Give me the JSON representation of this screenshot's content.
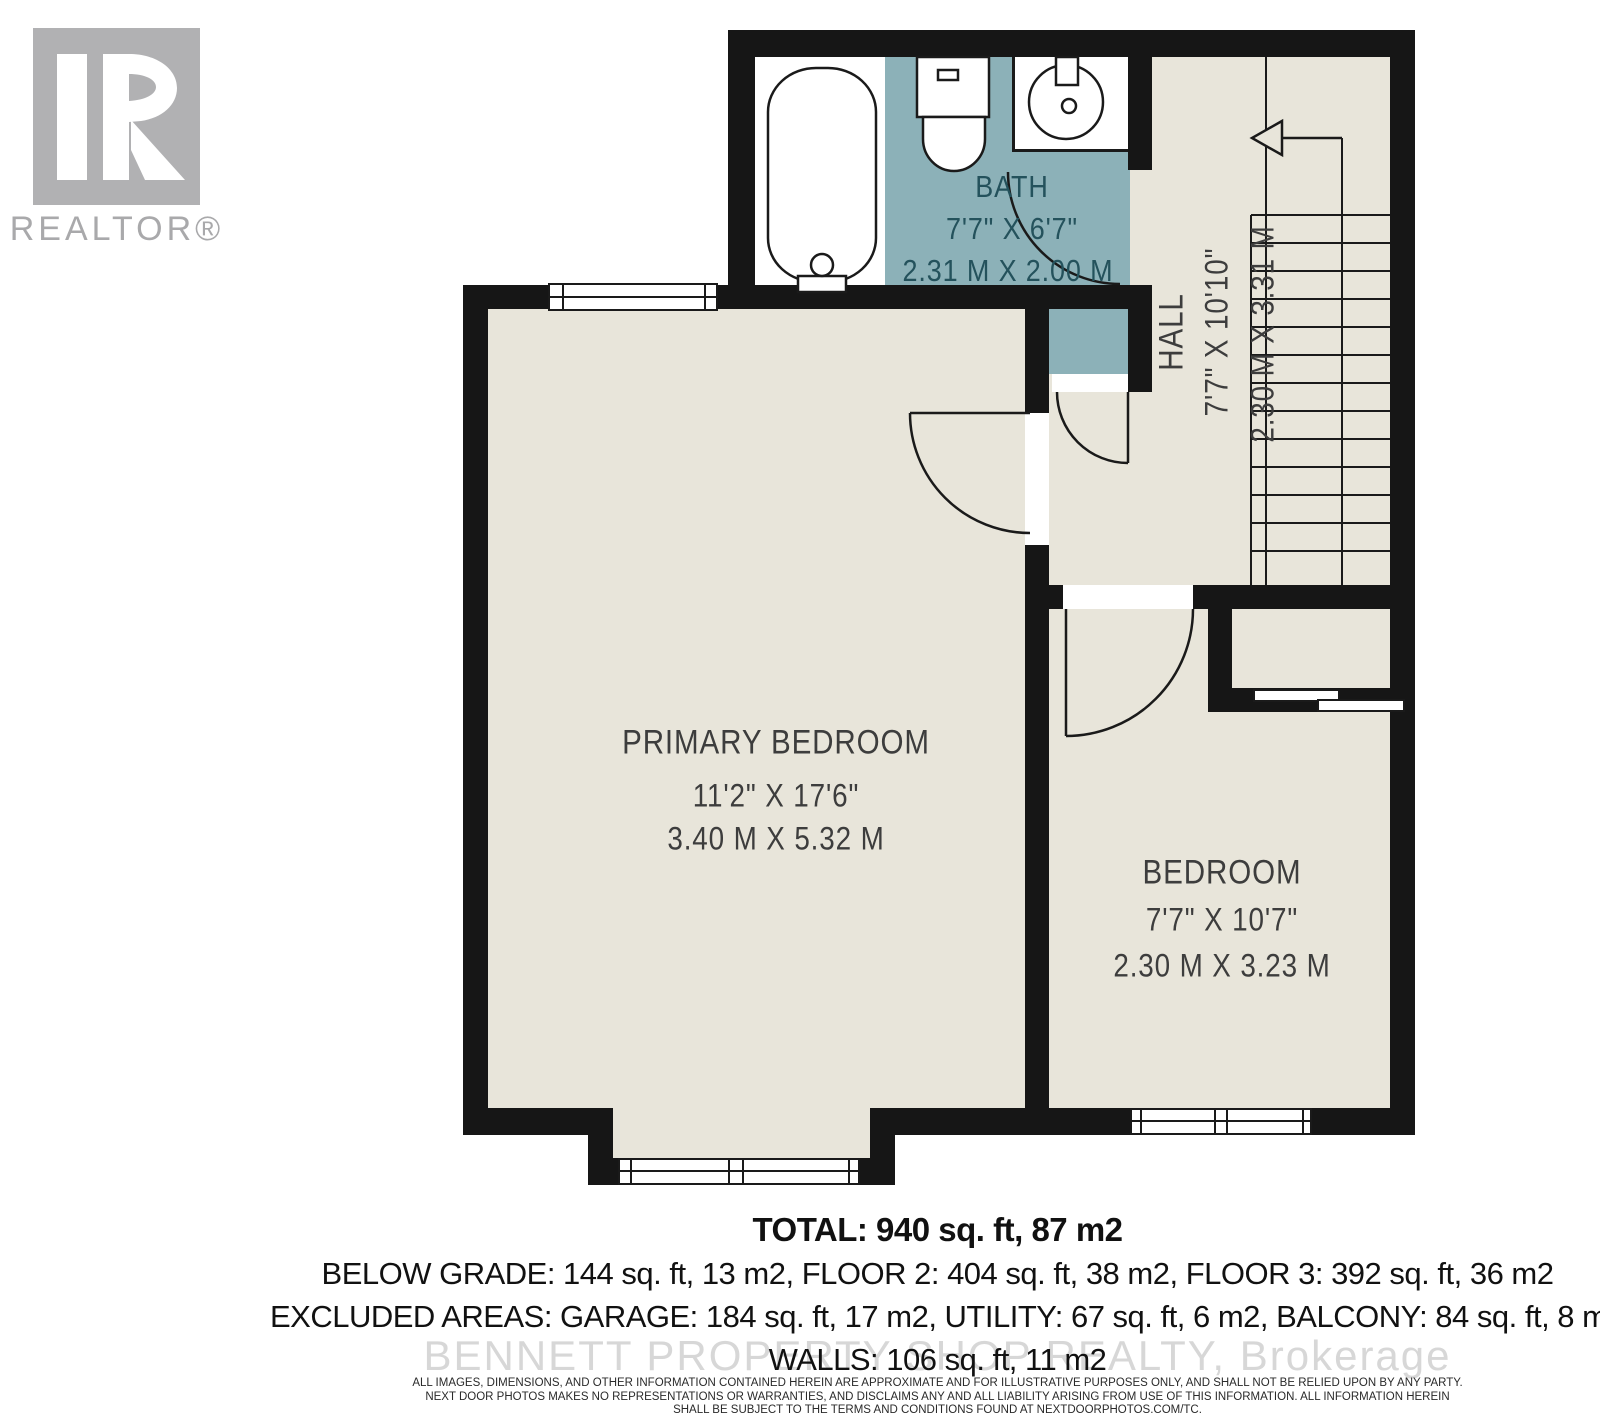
{
  "branding": {
    "realtor_logo_text": "REALTOR®",
    "watermark": "BENNETT PROPERTY SHOP REALTY, Brokerage"
  },
  "rooms": {
    "bath": {
      "name": "BATH",
      "imperial": "7'7\" X 6'7\"",
      "metric": "2.31 M X 2.00 M"
    },
    "hall": {
      "name": "HALL",
      "imperial": "7'7\" X 10'10\"",
      "metric": "2.30 M X 3.31 M"
    },
    "primary": {
      "name": "PRIMARY BEDROOM",
      "imperial": "11'2\" X 17'6\"",
      "metric": "3.40 M X 5.32 M"
    },
    "bedroom": {
      "name": "BEDROOM",
      "imperial": "7'7\" X 10'7\"",
      "metric": "2.30 M X 3.23 M"
    }
  },
  "summary": {
    "total": "TOTAL: 940 sq. ft, 87 m2",
    "grades": "BELOW GRADE: 144 sq. ft, 13 m2, FLOOR 2: 404 sq. ft, 38 m2, FLOOR 3: 392 sq. ft, 36 m2",
    "excluded": "EXCLUDED AREAS: GARAGE: 184 sq. ft, 17 m2, UTILITY: 67 sq. ft, 6 m2, BALCONY: 84 sq. ft, 8 m2,",
    "walls": "WALLS: 106 sq. ft, 11 m2"
  },
  "disclaimer": {
    "line1": "ALL IMAGES, DIMENSIONS, AND OTHER INFORMATION CONTAINED HEREIN ARE APPROXIMATE AND FOR ILLUSTRATIVE PURPOSES ONLY, AND SHALL NOT BE RELIED UPON BY ANY PARTY.",
    "line2": "NEXT DOOR PHOTOS MAKES NO REPRESENTATIONS OR WARRANTIES, AND DISCLAIMS ANY AND ALL LIABILITY ARISING FROM USE OF THIS INFORMATION. ALL INFORMATION HEREIN",
    "line3": "SHALL BE SUBJECT TO THE TERMS AND CONDITIONS FOUND AT NEXTDOORPHOTOS.COM/TC."
  },
  "colors": {
    "floor": "#e8e5da",
    "bath_floor": "#8cb1b8",
    "wall": "#161616",
    "bath_text": "#24525c",
    "label_text": "#3d3d3d",
    "watermark": "#d7d7d7",
    "logo_gray": "#b1b1b3"
  }
}
